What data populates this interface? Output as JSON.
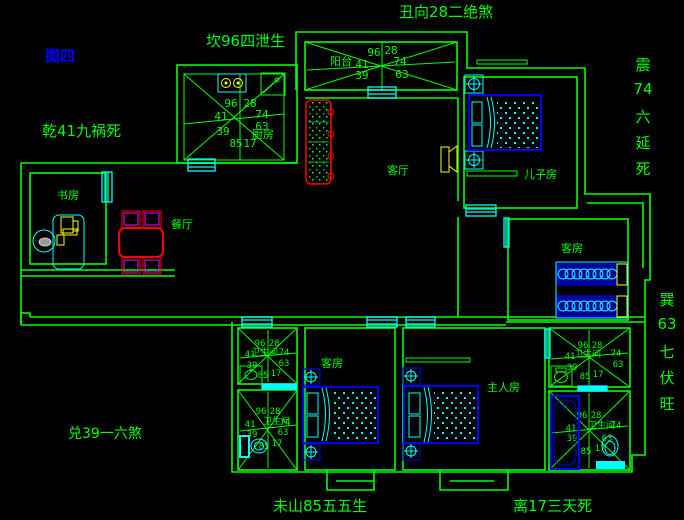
{
  "canvas": {
    "width": 684,
    "height": 520
  },
  "annotations": {
    "figure": "图四",
    "north": "丑向28二绝煞",
    "kan": "坎96四泄生",
    "qian": "乾41九祸死",
    "dui": "兑39一六煞",
    "wei": "未山85五五生",
    "li": "离17三天死",
    "zhen": [
      "震",
      "74",
      "六",
      "延",
      "死"
    ],
    "xun": [
      "巽",
      "63",
      "七",
      "伏",
      "旺"
    ]
  },
  "rooms": {
    "balcony": "阳台",
    "kitchen": "厨房",
    "living": "客厅",
    "son": "儿子房",
    "guest_right": "客房",
    "dining": "餐厅",
    "study": "书房",
    "master": "主人房",
    "guest_bottom": "客房",
    "bathroom": "卫生间"
  },
  "rose": {
    "nw": "96",
    "ne": "28",
    "w": "41",
    "e": "74",
    "sw": "39",
    "se": "63",
    "s1": "85",
    "s2": "17"
  },
  "colors": {
    "background": "#000000",
    "wall_green": "#00ff00",
    "window_cyan": "#00ffff",
    "furniture_blue": "#0000ff",
    "figure_blue": "#0000ff",
    "table_red": "#ff0000",
    "chair_magenta": "#ff00ff",
    "device_yellow": "#ffff00"
  }
}
